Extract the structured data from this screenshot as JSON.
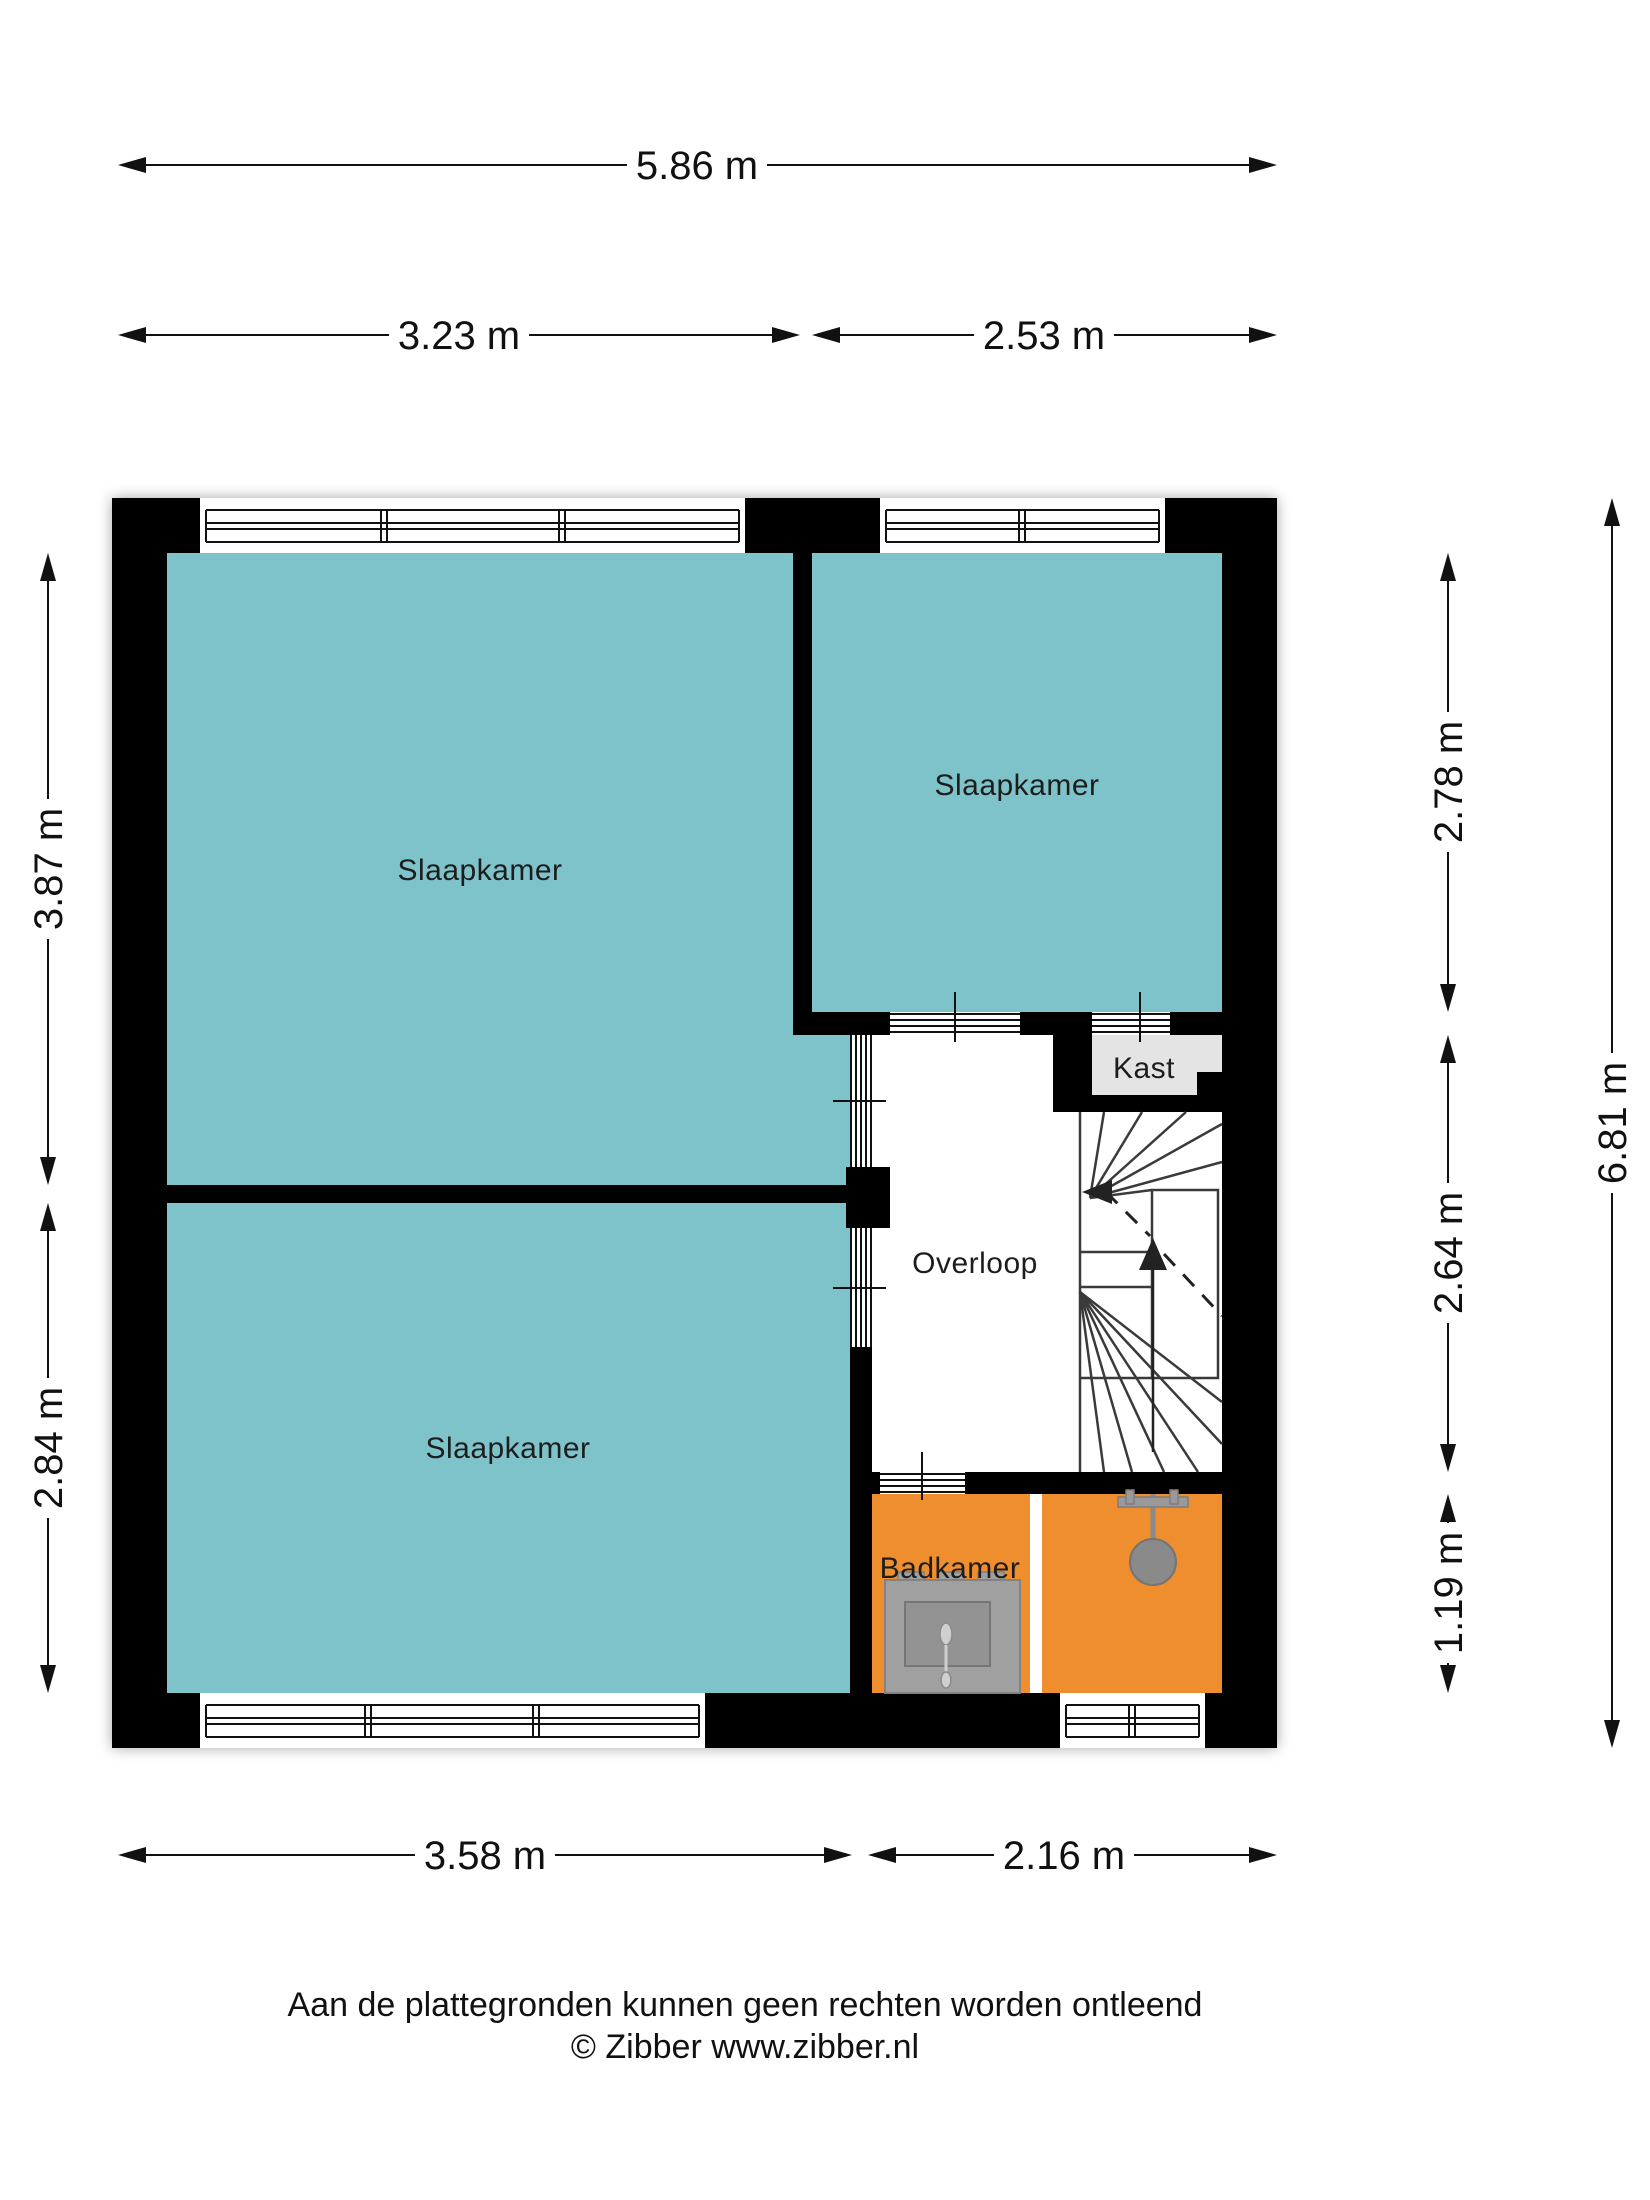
{
  "floorplan": {
    "rooms": {
      "slaapkamer_top_left": "Slaapkamer",
      "slaapkamer_top_right": "Slaapkamer",
      "slaapkamer_bottom_left": "Slaapkamer",
      "overloop": "Overloop",
      "kast": "Kast",
      "badkamer": "Badkamer"
    },
    "dimensions": {
      "top_total": "5.86 m",
      "top_left": "3.23 m",
      "top_right": "2.53 m",
      "left_upper": "3.87 m",
      "left_lower": "2.84 m",
      "right_upper": "2.78 m",
      "right_middle": "2.64 m",
      "right_lower": "1.19 m",
      "right_total": "6.81 m",
      "bottom_left": "3.58 m",
      "bottom_right": "2.16 m"
    },
    "colors": {
      "room_fill": "#7FC3CA",
      "bathroom_fill": "#EF8E2E",
      "closet_fill": "#E4E4E4",
      "wall": "#000000"
    },
    "footer": {
      "disclaimer": "Aan de plattegronden kunnen geen rechten worden ontleend",
      "copyright": "© Zibber www.zibber.nl"
    }
  }
}
